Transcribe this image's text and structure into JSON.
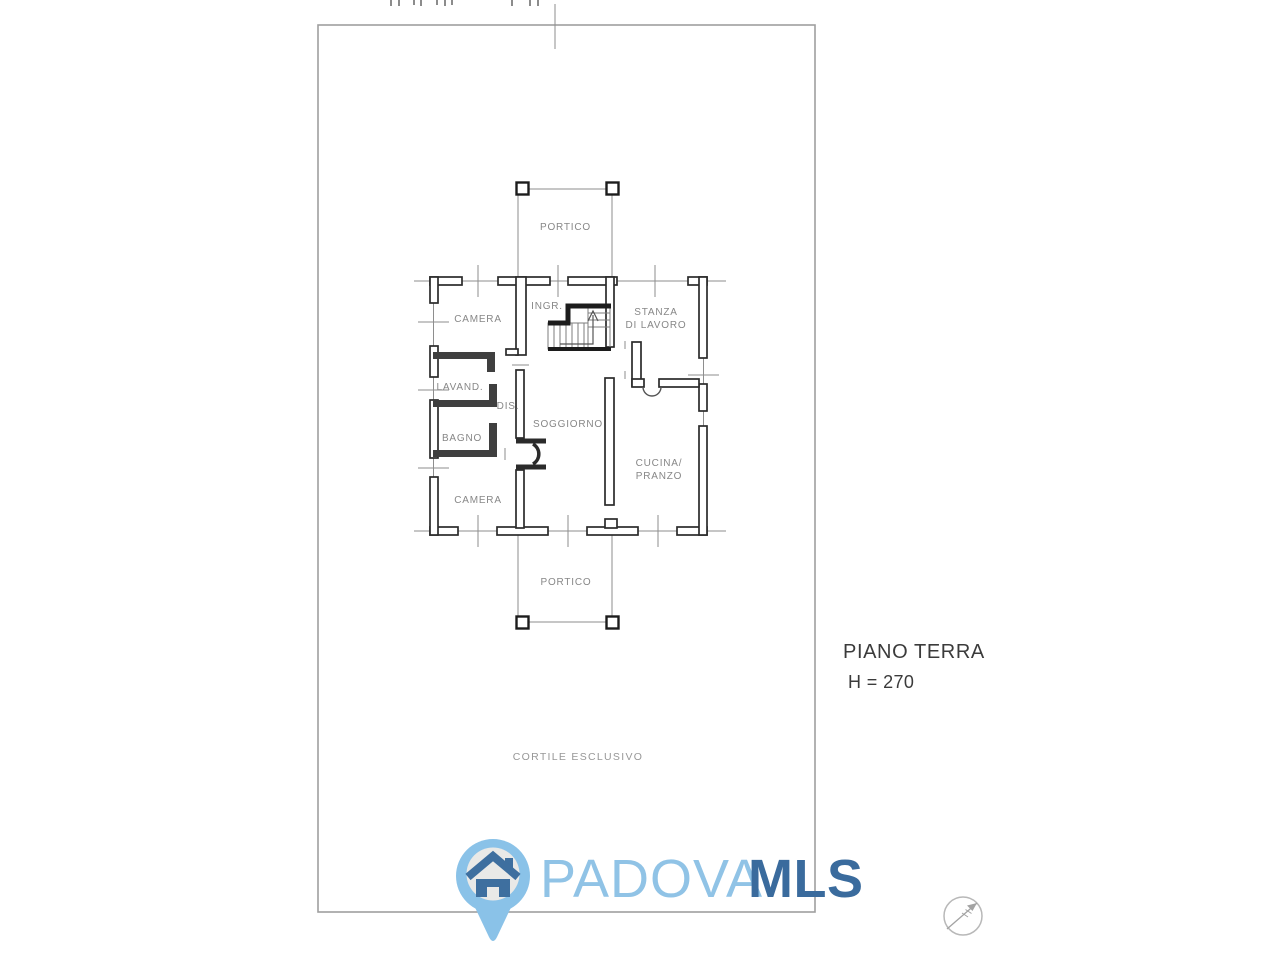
{
  "drawing": {
    "rooms": {
      "portico_top": "PORTICO",
      "camera_top": "CAMERA",
      "ingresso": "INGR.",
      "stanza_line1": "STANZA",
      "stanza_line2": "DI LAVORO",
      "lavanderia": "LAVAND.",
      "disimpegno": "DIS.",
      "bagno": "BAGNO",
      "soggiorno": "SOGGIORNO",
      "cucina_line1": "CUCINA/",
      "cucina_line2": "PRANZO",
      "camera_bottom": "CAMERA",
      "portico_bottom": "PORTICO"
    },
    "site_label": "CORTILE ESCLUSIVO",
    "floor_label": "PIANO TERRA",
    "height_label": "H = 270"
  },
  "branding": {
    "name_light": "PADOVA",
    "name_bold": "MLS",
    "colors": {
      "wordmark_light_blue": "#90c3e6",
      "wordmark_dark_blue": "#3a6b9d",
      "pin_fill": "#8ac2e8",
      "pin_inner": "#e9e9e7",
      "house_blue": "#3e6f9f"
    }
  },
  "icons": {
    "compass": "north-arrow-compass",
    "logo_pin": "map-pin-house"
  }
}
